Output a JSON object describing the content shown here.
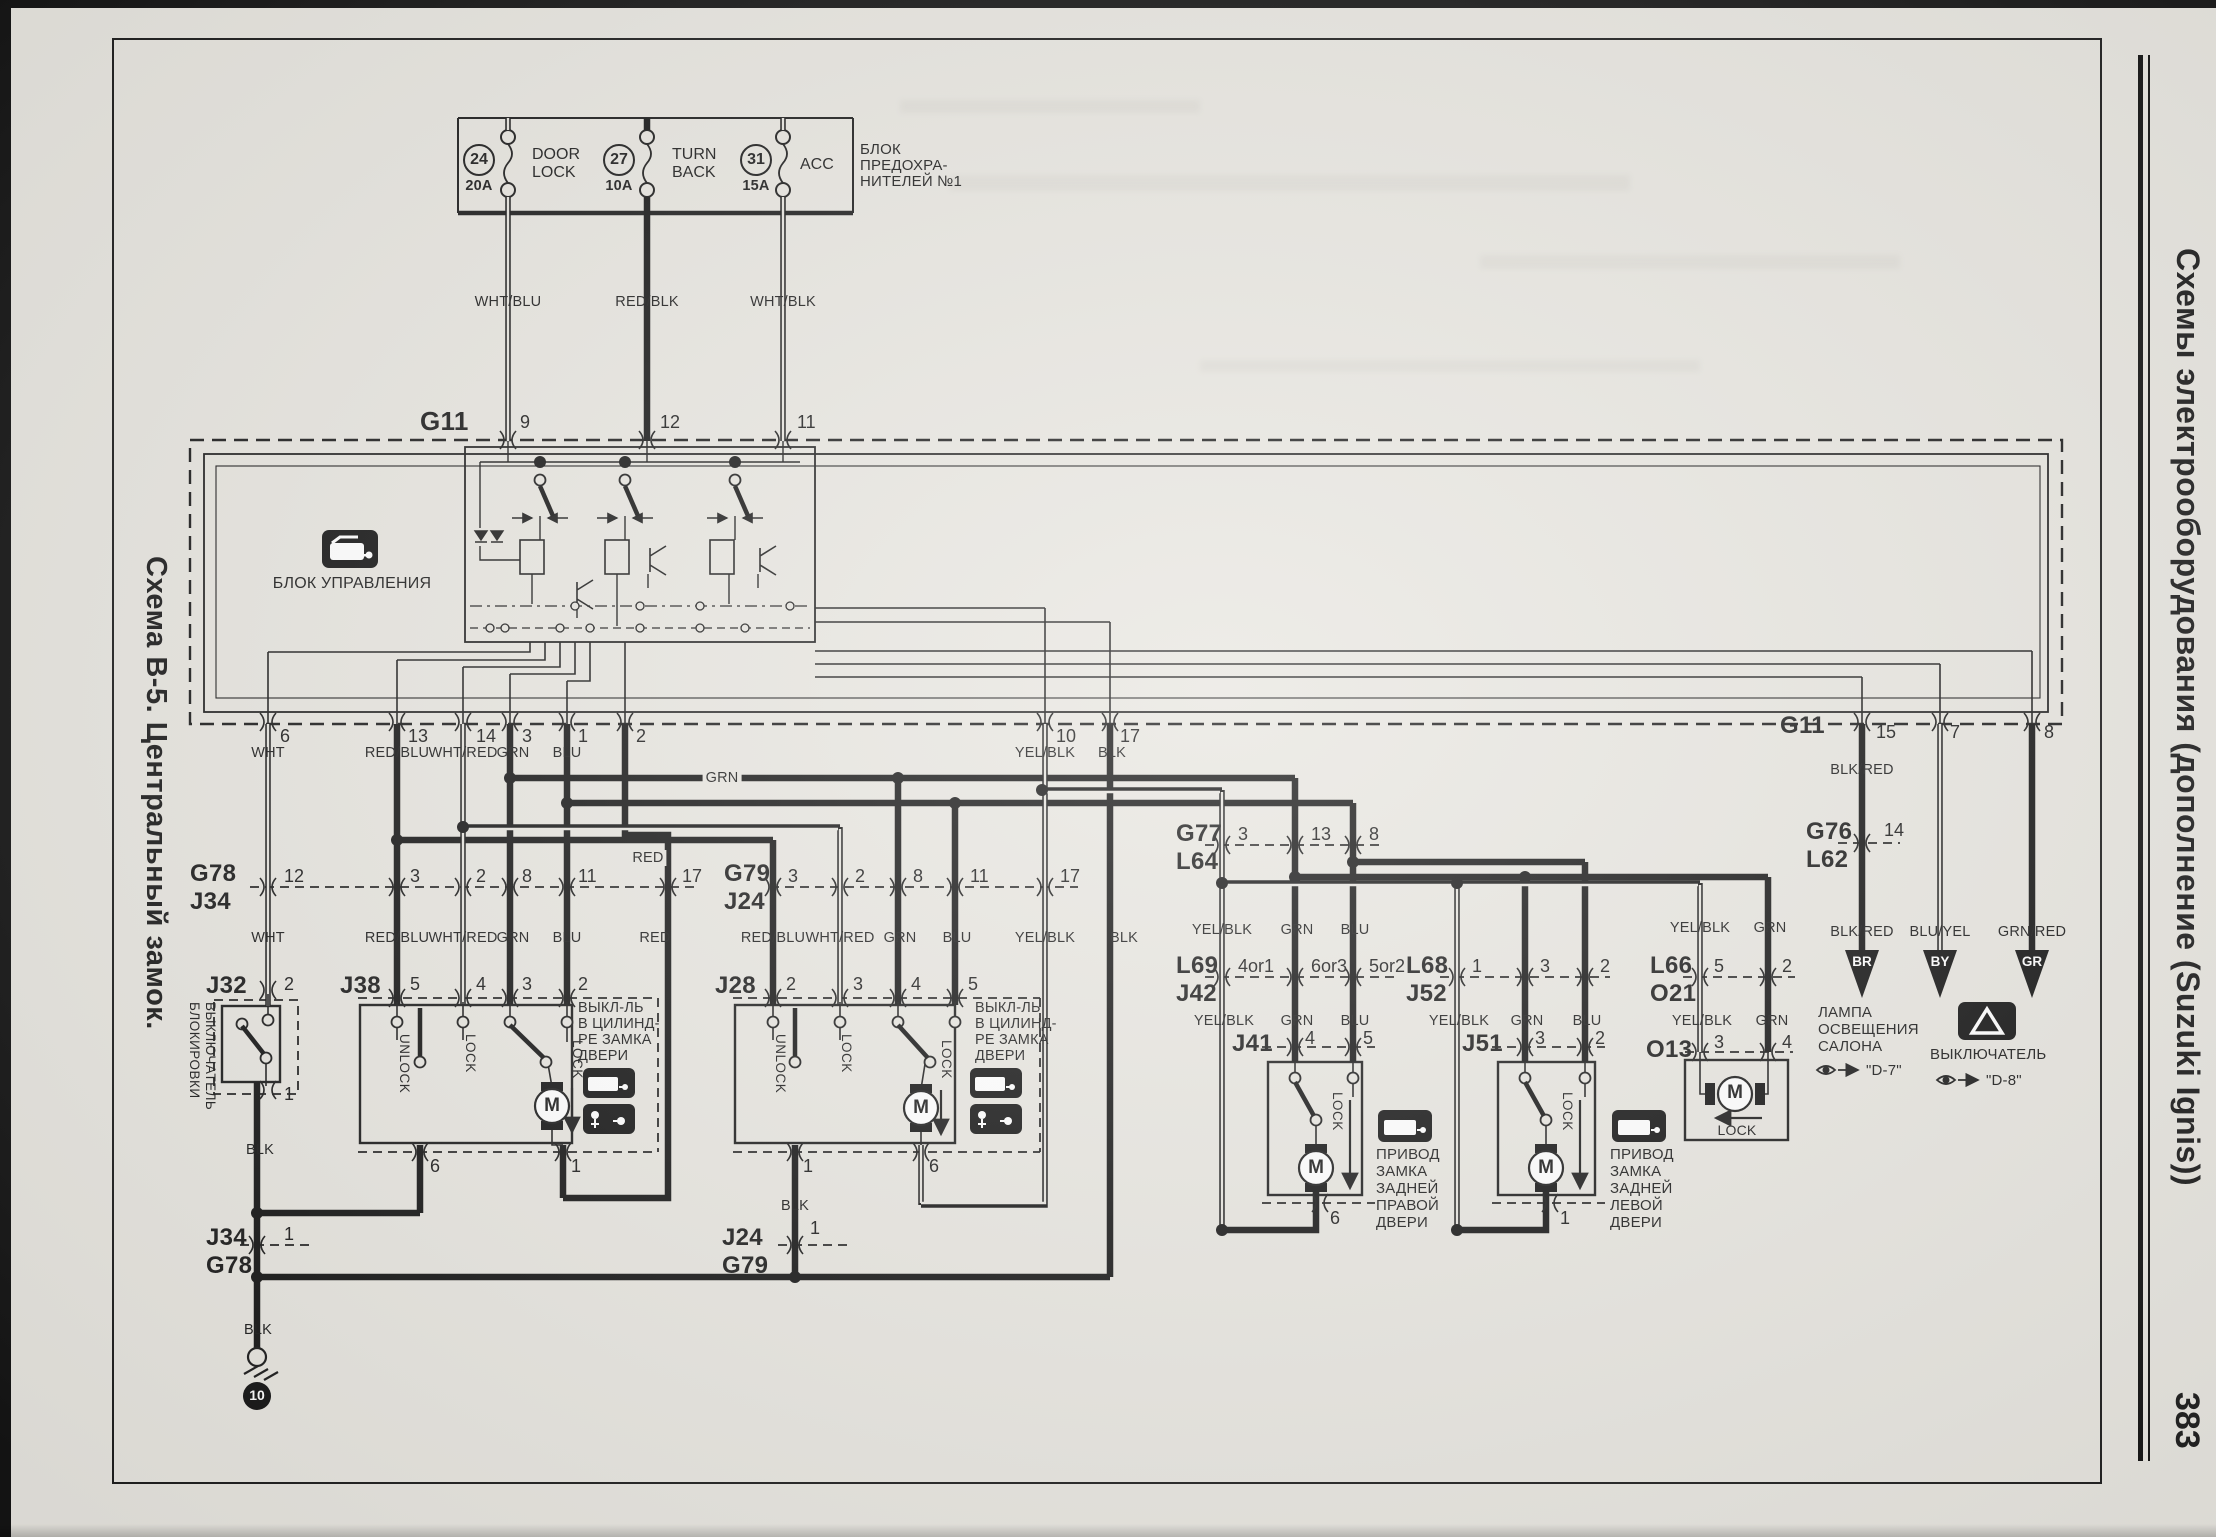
{
  "page": {
    "left_title": "Схема B-5. Центральный замок.",
    "right_title": "Схемы электрооборудования (дополнение (Suzuki Ignis))",
    "page_number": "383"
  },
  "fuse_box": {
    "title_l1": "БЛОК",
    "title_l2": "ПРЕДОХРА-",
    "title_l3": "НИТЕЛЕЙ №1",
    "fuses": [
      {
        "num": "24",
        "amp": "20A",
        "name_l1": "DOOR",
        "name_l2": "LOCK"
      },
      {
        "num": "27",
        "amp": "10A",
        "name_l1": "TURN",
        "name_l2": "BACK"
      },
      {
        "num": "31",
        "amp": "15A",
        "name_l1": "ACC",
        "name_l2": ""
      }
    ]
  },
  "control_unit": {
    "connector": "G11",
    "pin9": "9",
    "pin12": "12",
    "pin11": "11",
    "label": "БЛОК УПРАВЛЕНИЯ",
    "bp6": "6",
    "bp13": "13",
    "bp14": "14",
    "bp3": "3",
    "bp1": "1",
    "bp2": "2",
    "bp10": "10",
    "bp17": "17",
    "right_connector": "G11",
    "rp15": "15",
    "rp7": "7",
    "rp8": "8"
  },
  "wires": {
    "wht_blu": "WHT/BLU",
    "red_blk": "RED/BLK",
    "wht_blk": "WHT/BLK",
    "wht": "WHT",
    "red_blu": "RED/BLU",
    "wht_red": "WHT/RED",
    "grn": "GRN",
    "blu": "BLU",
    "red": "RED",
    "yel_blk": "YEL/BLK",
    "blk": "BLK",
    "blk_red": "BLK/RED",
    "blu_yel": "BLU/YEL",
    "grn_red": "GRN/RED"
  },
  "connectors": {
    "g78": "G78",
    "j34": "J34",
    "g79": "G79",
    "j24": "J24",
    "g77": "G77",
    "l64": "L64",
    "l69": "L69",
    "j42": "J42",
    "l68": "L68",
    "j52": "J52",
    "l66": "L66",
    "o21": "O21",
    "g76": "G76",
    "l62": "L62",
    "g78j34_pins": [
      "12",
      "3",
      "2",
      "8",
      "11",
      "17"
    ],
    "g79j24_pins": [
      "3",
      "2",
      "8",
      "11",
      "17"
    ],
    "g77l64_pins": [
      "3",
      "13",
      "8"
    ],
    "l69j42_pins": [
      "4or1",
      "6or3",
      "5or2"
    ],
    "l68j52_pins": [
      "1",
      "3",
      "2"
    ],
    "l66o21_pins": [
      "5",
      "2"
    ],
    "g76l62_pin": "14",
    "j34g78_pin": "1",
    "j24g79_pin": "1"
  },
  "j32": {
    "name": "J32",
    "pin_top": "2",
    "pin_bottom": "1",
    "label_l1": "ВЫКЛЮЧАТЕЛЬ",
    "label_l2": "БЛОКИРОВКИ"
  },
  "j38": {
    "name": "J38",
    "p1": "5",
    "p2": "4",
    "p3": "3",
    "p4": "2",
    "unlock": "UNLOCK",
    "lock": "LOCK",
    "lock2": "LOCK",
    "motor": "M",
    "b1": "6",
    "b2": "1"
  },
  "j28": {
    "name": "J28",
    "p1": "2",
    "p2": "3",
    "p3": "4",
    "p4": "5",
    "unlock": "UNLOCK",
    "lock": "LOCK",
    "lock2": "LOCK",
    "motor": "M",
    "b1": "1",
    "b2": "6"
  },
  "cyl_switch": {
    "l1": "ВЫКЛ-ЛЬ",
    "l2": "В ЦИЛИНД-",
    "l3": "РЕ ЗАМКА",
    "l4": "ДВЕРИ"
  },
  "j41": {
    "name": "J41",
    "p1": "4",
    "p2": "5",
    "b": "6",
    "lock": "LOCK",
    "motor": "M",
    "label": [
      "ПРИВОД",
      "ЗАМКА",
      "ЗАДНЕЙ",
      "ПРАВОЙ",
      "ДВЕРИ"
    ]
  },
  "j51": {
    "name": "J51",
    "p1": "3",
    "p2": "2",
    "b": "1",
    "lock": "LOCK",
    "motor": "M",
    "label": [
      "ПРИВОД",
      "ЗАМКА",
      "ЗАДНЕЙ",
      "ЛЕВОЙ",
      "ДВЕРИ"
    ]
  },
  "o13": {
    "name": "O13",
    "p1": "3",
    "p2": "4",
    "lock": "LOCK",
    "motor": "M"
  },
  "ground": {
    "num": "10"
  },
  "outputs": {
    "br": "BR",
    "by": "BY",
    "gr": "GR",
    "lamp_l1": "ЛАМПА",
    "lamp_l2": "ОСВЕЩЕНИЯ",
    "lamp_l3": "САЛОНА",
    "lamp_ref": "\"D-7\"",
    "sw": "ВЫКЛЮЧАТЕЛЬ",
    "sw_ref": "\"D-8\""
  }
}
